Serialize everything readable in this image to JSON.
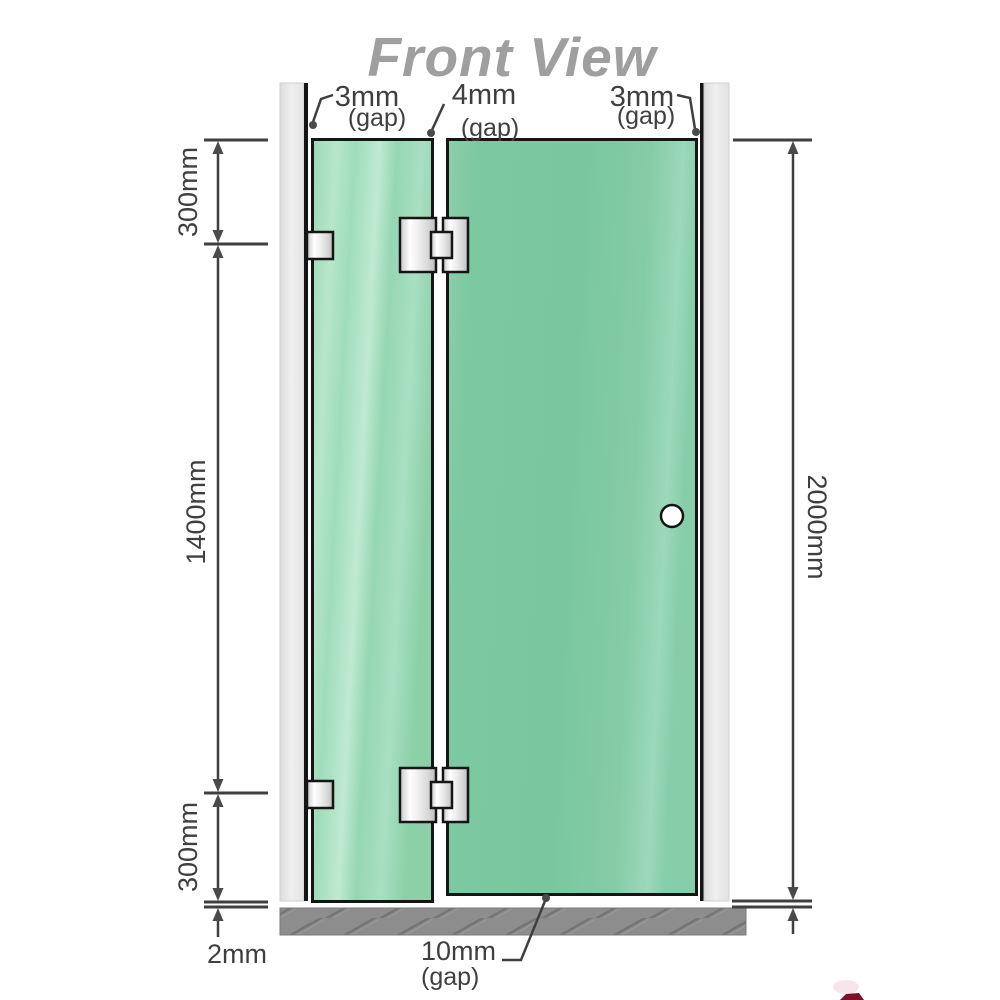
{
  "title": "Front View",
  "labels": {
    "gap_top_left": "3mm",
    "gap_top_left_sub": "(gap)",
    "gap_top_mid": "4mm",
    "gap_top_mid_sub": "(gap)",
    "gap_top_right": "3mm",
    "gap_top_right_sub": "(gap)",
    "panel_top_offset": "300mm",
    "panel_middle_span": "1400mm",
    "panel_bottom_offset": "300mm",
    "total_height": "2000mm",
    "floor_gap": "2mm",
    "door_bottom_gap": "10mm",
    "door_bottom_gap_sub": "(gap)"
  },
  "colors": {
    "title": "#9f9f9f",
    "dimension_lines": "#3f3f3f",
    "glass_fixed_panel": "#9ed9b8",
    "glass_door_panel": "#7cc8a0",
    "wall": "#e9e9e9",
    "floor": "#8d8d8d",
    "hinge_metal": "#ececec",
    "outline": "#151515",
    "logo_red": "#7d1126"
  }
}
